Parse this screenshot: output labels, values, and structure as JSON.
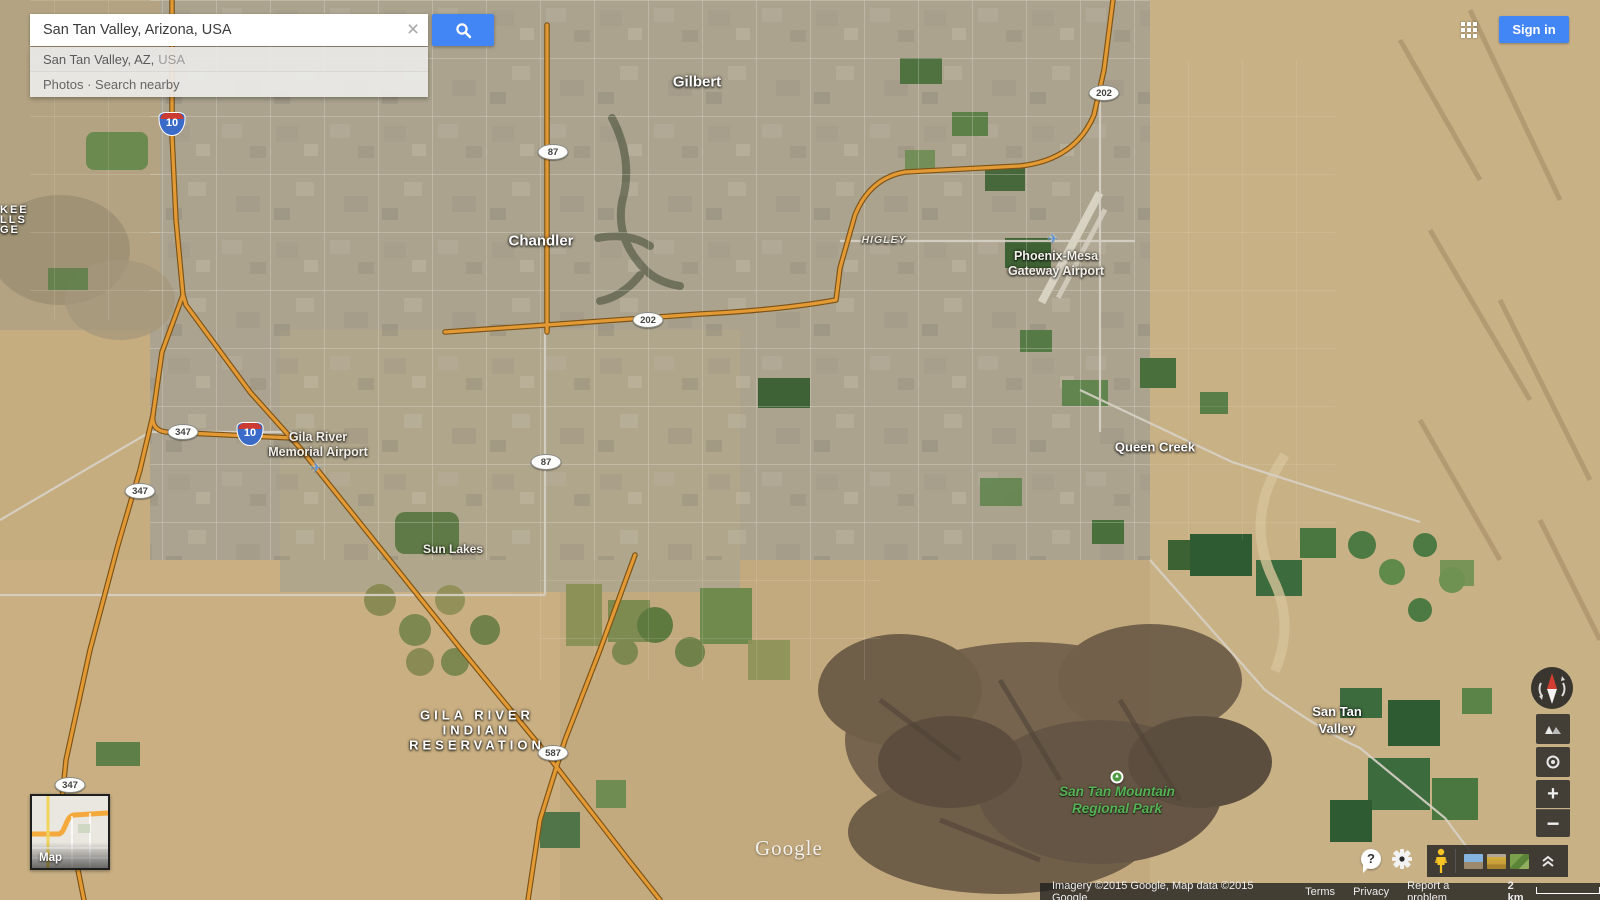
{
  "search": {
    "query": "San Tan Valley, Arizona, USA",
    "suggestion_primary": "San Tan Valley, AZ,",
    "suggestion_secondary": "USA",
    "actions_row": "Photos · Search nearby"
  },
  "header": {
    "sign_in_label": "Sign in"
  },
  "map": {
    "labels": {
      "gilbert": "Gilbert",
      "chandler": "Chandler",
      "higley": "HIGLEY",
      "phoenix_mesa_1": "Phoenix-Mesa",
      "phoenix_mesa_2": "Gateway Airport",
      "gila_airport_1": "Gila River",
      "gila_airport_2": "Memorial Airport",
      "queen_creek": "Queen Creek",
      "sun_lakes": "Sun Lakes",
      "san_tan_valley_1": "San Tan",
      "san_tan_valley_2": "Valley",
      "reservation_1": "GILA RIVER",
      "reservation_2": "INDIAN",
      "reservation_3": "RESERVATION",
      "park_1": "San Tan Mountain",
      "park_2": "Regional Park",
      "edge_1": "KEE",
      "edge_2": "LLS",
      "edge_3": "GE"
    },
    "shields": {
      "interstate_10": "10",
      "state_87": "87",
      "loop_202": "202",
      "state_347": "347",
      "state_587": "587"
    },
    "watermark": "Google"
  },
  "icons": {
    "clear": "×",
    "zoom_in": "+",
    "zoom_out": "−",
    "help": "?",
    "airplane": "✈",
    "tree": "▲"
  },
  "minimap": {
    "label": "Map"
  },
  "attribution": {
    "imagery": "Imagery ©2015 Google, Map data ©2015 Google",
    "terms": "Terms",
    "privacy": "Privacy",
    "report": "Report a problem",
    "scale": "2 km"
  },
  "colors": {
    "accent_blue": "#4285f4",
    "pegman_yellow": "#f7c325",
    "highway_orange": "#e39a35",
    "interstate_shield_blue": "#3a6bc9",
    "interstate_shield_red": "#cc3b31",
    "park_green": "#55b255"
  }
}
